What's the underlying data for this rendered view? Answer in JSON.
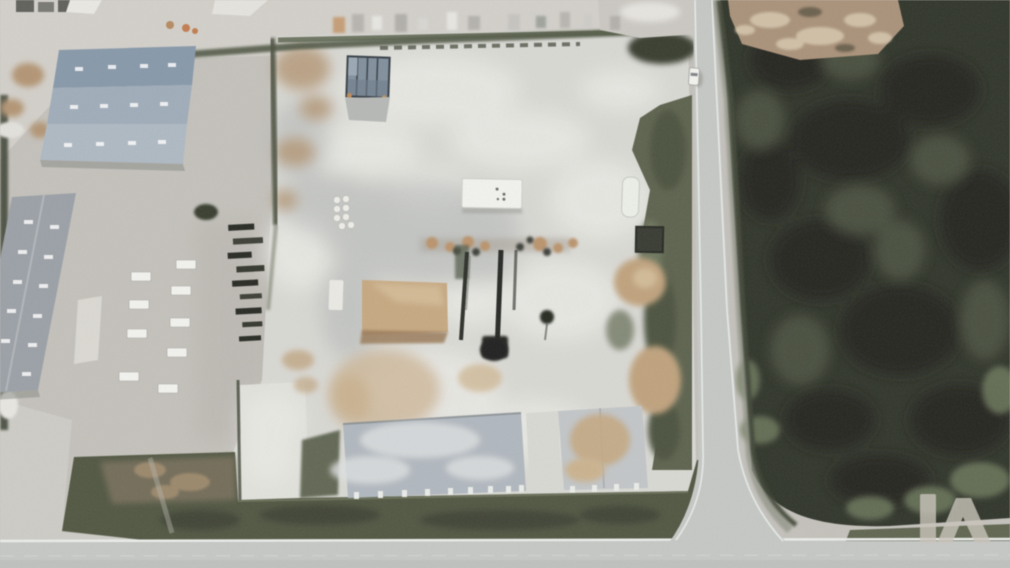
{
  "scene": {
    "type": "aerial-photograph",
    "description": "Aerial top-down view of an industrial site: a large white demolition pad with sawdust piles and conveyor remnants, a blue-roofed warehouse and a gray-roofed warehouse on the left, pallet stacks and lumber piles in a gravel yard, foundation slabs along the bottom, a two-lane road running down the right side meeting a horizontal road at the bottom, and a dark scrub field on the right with a cleared dirt patch at top.",
    "elements": [
      "blue-roof-warehouse",
      "gray-roof-warehouse",
      "demolition-pad",
      "sawdust-pile",
      "conveyor-remnants",
      "office-trailer",
      "clarifier-basin",
      "storage-tank-cluster",
      "pallet-stacks",
      "lumber-piles",
      "foundation-slabs",
      "perimeter-grass",
      "vertical-road",
      "horizontal-road",
      "road-intersection",
      "scrub-field",
      "cleared-dirt-patch",
      "white-car",
      "watermark-logo"
    ]
  },
  "watermark": {
    "monogram": "LA",
    "aria_label": "LA watermark logo",
    "opacity": "0.8"
  },
  "palette": {
    "gravel": "#c5c2bb",
    "concrete_light": "#d6d4cd",
    "pad": "#dadad4",
    "pad_bright": "#ebebe6",
    "slab_blue": "#b0b8bf",
    "slab_gray": "#c3c7c9",
    "field": "#2d3227",
    "field_shadow": "#20241b",
    "field_light": "#49513c",
    "scrub": "#6d7a5a",
    "hedge": "#47503a",
    "grass_band": "#4e553e",
    "road": "#c6c9c6",
    "road_line": "#edefec",
    "blue_roof": "#8598ab",
    "blue_roof_mid": "#9fadbb",
    "blue_roof_light": "#aebac4",
    "gray_roof": "#9aa0a7",
    "sawdust": "#c9a87d",
    "sawdust_dark": "#9c7a54",
    "soil": "#b5946f",
    "tan_field": "#ab9176",
    "steel": "#1d1f1c",
    "basin": "#7f8f9d",
    "basin_frame": "#333d45",
    "white_structure": "#f4f4f0",
    "watermark": "#cbc5ba"
  }
}
